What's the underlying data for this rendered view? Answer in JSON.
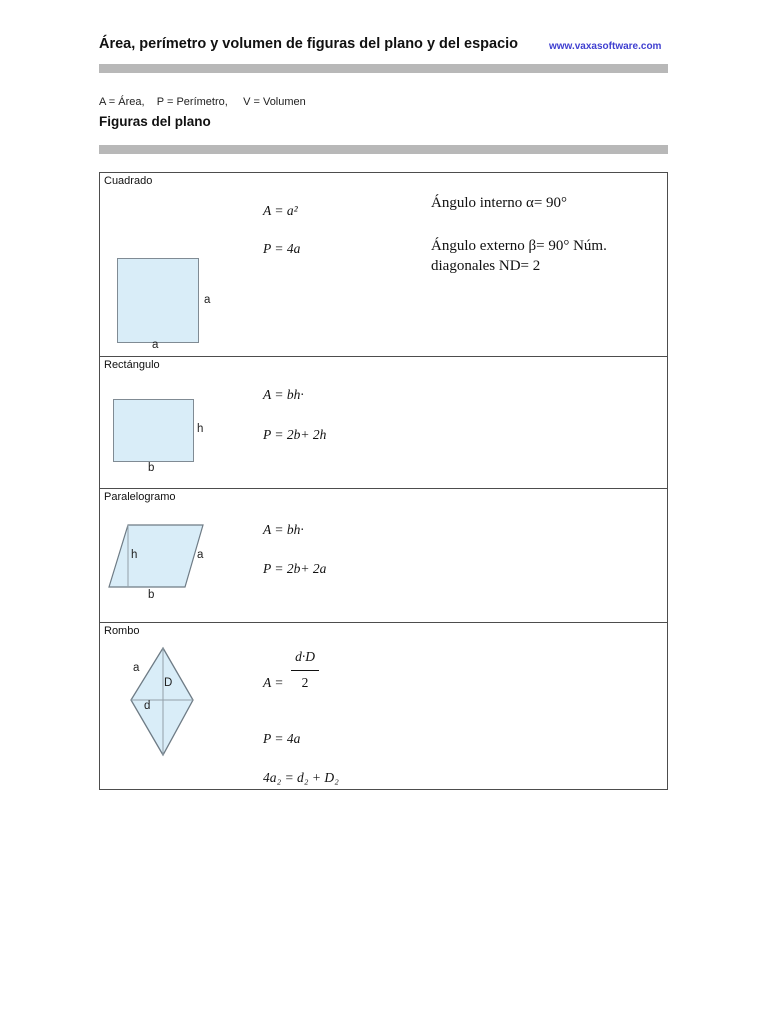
{
  "header": {
    "title": "Área, perímetro y volumen de figuras del plano y del espacio",
    "website": "www.vaxasoftware.com"
  },
  "intro": {
    "legend": "A = Área,    P = Perímetro,     V = Volumen",
    "section_heading": "Figuras del plano"
  },
  "colors": {
    "link_blue": "#3f3fd0",
    "divider_gray": "#b8b8b8",
    "shape_fill": "#d9edf8",
    "shape_stroke": "#808b94",
    "table_border": "#4d4d4d"
  },
  "figures": [
    {
      "name": "Cuadrado",
      "labels": {
        "side": "a",
        "base": "a"
      },
      "formulas": {
        "area": "A = a²",
        "perimeter": "P = 4a"
      },
      "notes": {
        "internal_angle": "Ángulo interno α= 90°",
        "external_angle": "Ángulo externo β= 90° Núm. diagonales ND= 2"
      }
    },
    {
      "name": "Rectángulo",
      "labels": {
        "height": "h",
        "base": "b"
      },
      "formulas": {
        "area": "A = bh·",
        "perimeter": "P = 2b+ 2h"
      }
    },
    {
      "name": "Paralelogramo",
      "labels": {
        "height": "h",
        "side": "a",
        "base": "b"
      },
      "formulas": {
        "area": "A = bh·",
        "perimeter": "P = 2b+ 2a"
      }
    },
    {
      "name": "Rombo",
      "labels": {
        "side": "a",
        "diagonal_major": "D",
        "diagonal_minor": "d"
      },
      "formulas": {
        "area_lhs": "A =",
        "area_numerator": "d·D",
        "area_denominator": "2",
        "perimeter": "P = 4a",
        "relation": "4a₂ = d₂ + D₂"
      }
    }
  ]
}
